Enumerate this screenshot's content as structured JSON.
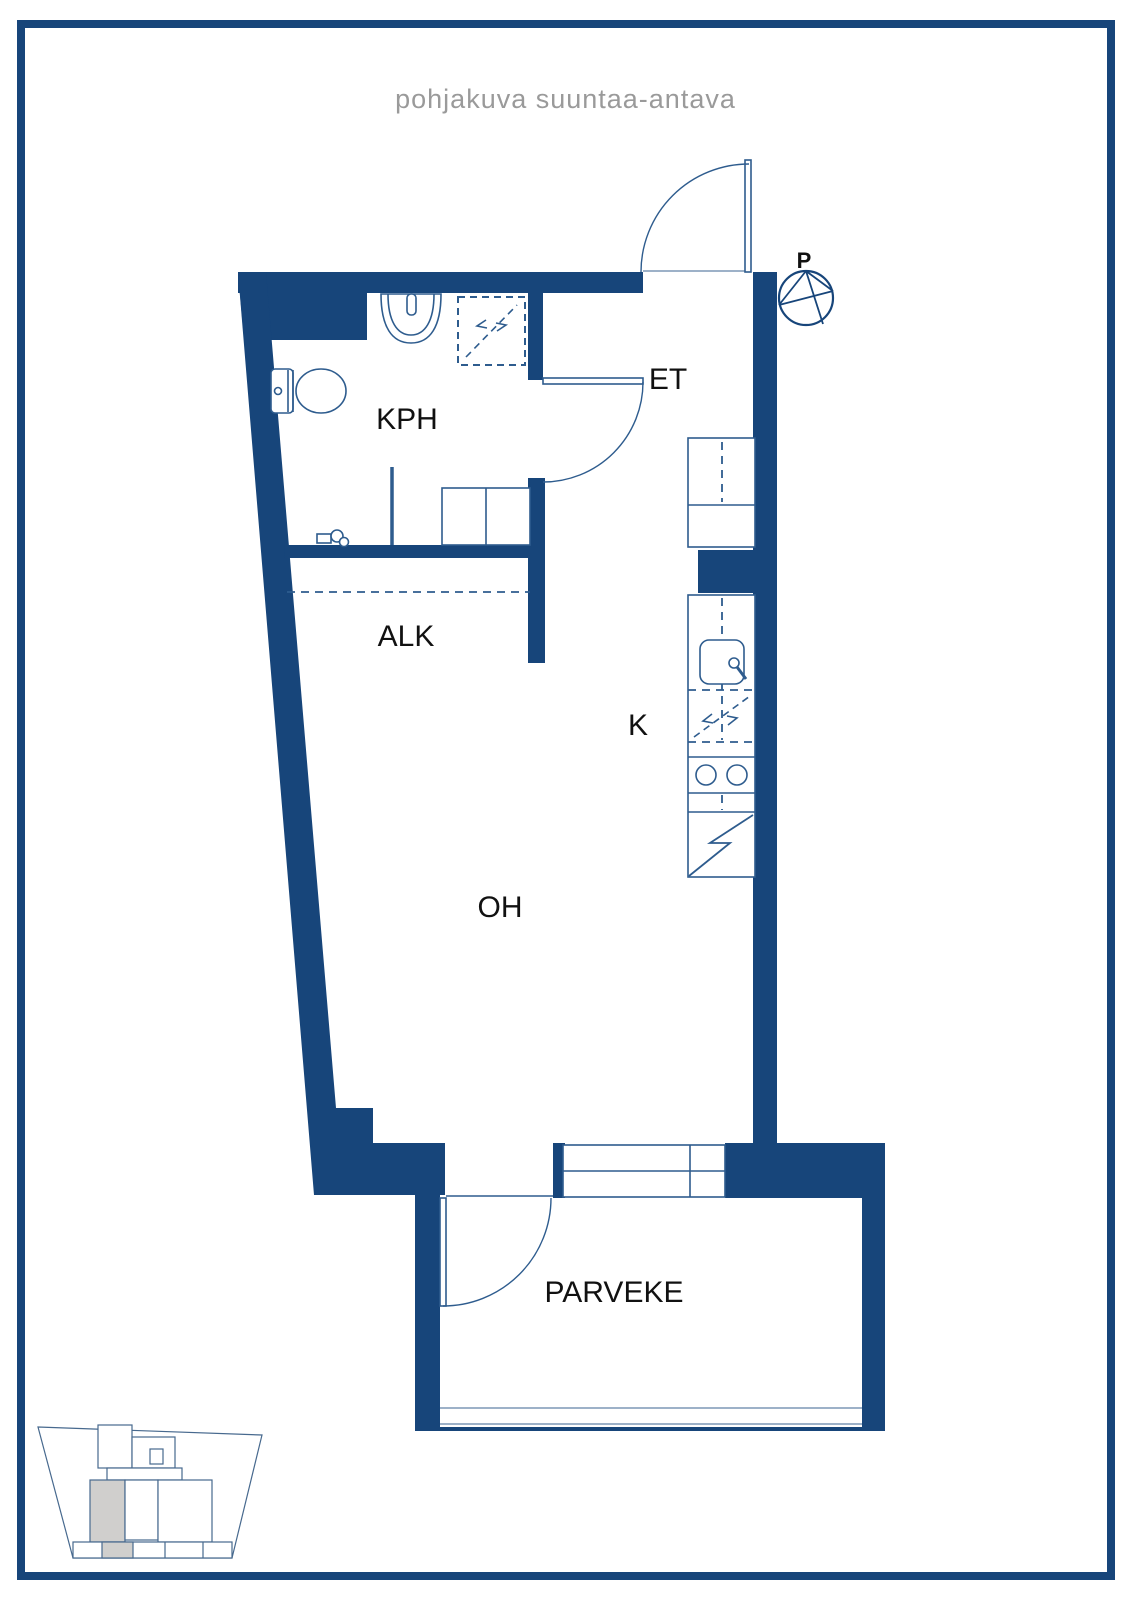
{
  "title": "pohjakuva suuntaa-antava",
  "rooms": {
    "bathroom": "KPH",
    "entry": "ET",
    "alcove": "ALK",
    "kitchen": "K",
    "living_room": "OH",
    "balcony": "PARVEKE"
  },
  "compass": {
    "north_label": "P"
  },
  "colors": {
    "wall": "#17457a",
    "fixture_line": "#2e5c8e",
    "railing_line": "#7d97b5",
    "title_text": "#9a9a9a",
    "label_text": "#111111",
    "unit_highlight": "#d0cfcd"
  }
}
